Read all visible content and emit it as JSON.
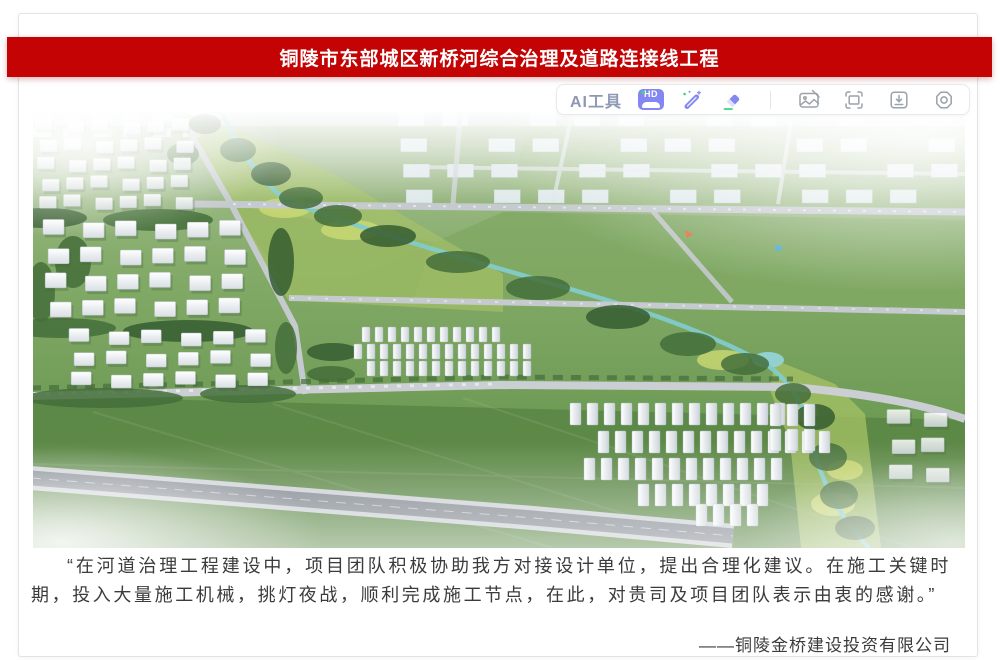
{
  "banner": {
    "title": "铜陵市东部城区新桥河综合治理及道路连接线工程",
    "bg_color": "#c40404",
    "text_color": "#ffffff"
  },
  "toolbar": {
    "ai_tools_label": "AI工具",
    "hd_badge_text": "HD",
    "accent_color": "#8487f2",
    "green_accent_color": "#3ed47e",
    "gray_icon_color": "#9aa2ab",
    "icons": [
      "hd-icon",
      "magic-pen-icon",
      "eraser-icon",
      "image-edit-icon",
      "expand-icon",
      "download-icon",
      "settings-gear-icon"
    ]
  },
  "hero_image": {
    "description": "新桥河综合治理及道路连接线工程鸟瞰效果图：河道绿廊、道路网、居住组团与施工营地"
  },
  "testimonial": {
    "quote": "“在河道治理工程建设中，项目团队积极协助我方对接设计单位，提出合理化建议。在施工关键时期，投入大量施工机械，挑灯夜战，顺利完成施工节点，在此，对贵司及项目团队表示由衷的感谢。”",
    "attribution": "——铜陵金桥建设投资有限公司"
  }
}
